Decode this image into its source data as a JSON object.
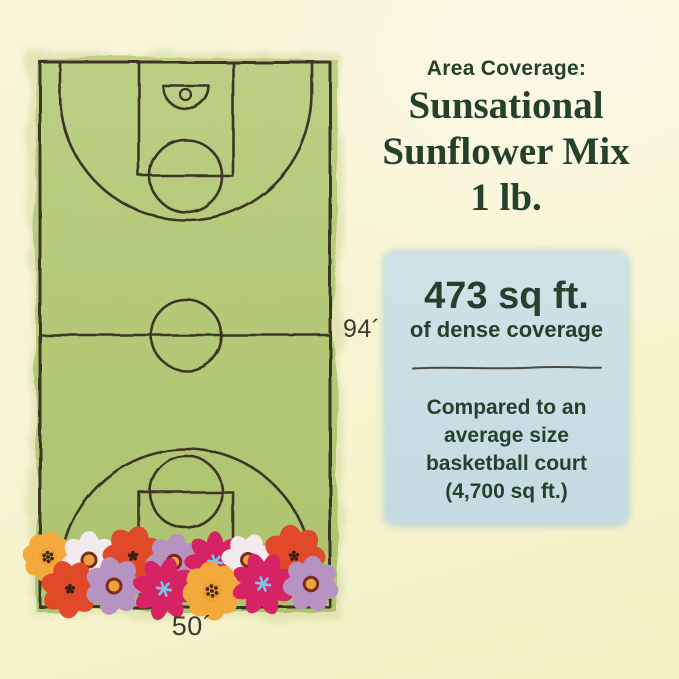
{
  "header": {
    "kicker": "Area Coverage:",
    "title_lines": [
      "Sunsational",
      "Sunflower Mix",
      "1 lb."
    ]
  },
  "stat_card": {
    "value": "473 sq ft.",
    "value_caption": "of dense coverage",
    "comparison_lines": [
      "Compared to an",
      "average size",
      "basketball court",
      "(4,700 sq ft.)"
    ]
  },
  "court": {
    "length_label": "94´",
    "width_label": "50´"
  },
  "colors": {
    "background": "#f7f4d1",
    "court_green": "#b5ca77",
    "line_ink": "#3e3426",
    "text_green": "#25402d",
    "card_blue": "#cadee4",
    "label_ink": "#3c3b30"
  },
  "illustration": {
    "flower_palette": {
      "marigold": {
        "petal": "#f4a93c",
        "center": "#f0a231",
        "dots": "#3a2a16"
      },
      "daisy": {
        "petal": "#f3eaee",
        "center": "#e8a23c",
        "ring": "#7c2d1d"
      },
      "poppy": {
        "petal": "#e04a28",
        "dots": "#2e1c12"
      },
      "cosmos_lavender": {
        "petal": "#b793c2",
        "center": "#eaa43c",
        "ring": "#7c2b20"
      },
      "cosmos_magenta": {
        "petal": "#d62364",
        "star": "#7cc4e7"
      }
    },
    "flowers": [
      {
        "x": 48,
        "y": 557,
        "r": 25,
        "type": "marigold",
        "rot": 10
      },
      {
        "x": 89,
        "y": 560,
        "r": 28,
        "type": "daisy",
        "rot": 0
      },
      {
        "x": 133,
        "y": 556,
        "r": 29,
        "type": "poppy",
        "rot": 15
      },
      {
        "x": 174,
        "y": 562,
        "r": 27,
        "type": "cosmos_lavender",
        "rot": 8
      },
      {
        "x": 215,
        "y": 562,
        "r": 28,
        "type": "cosmos_magenta",
        "rot": 0
      },
      {
        "x": 248,
        "y": 560,
        "r": 26,
        "type": "daisy",
        "rot": 20
      },
      {
        "x": 294,
        "y": 556,
        "r": 30,
        "type": "poppy",
        "rot": -10
      },
      {
        "x": 70,
        "y": 589,
        "r": 28,
        "type": "poppy",
        "rot": 30
      },
      {
        "x": 114,
        "y": 586,
        "r": 28,
        "type": "cosmos_lavender",
        "rot": -12
      },
      {
        "x": 164,
        "y": 589,
        "r": 29,
        "type": "cosmos_magenta",
        "rot": 14
      },
      {
        "x": 212,
        "y": 591,
        "r": 29,
        "type": "marigold",
        "rot": -6
      },
      {
        "x": 263,
        "y": 584,
        "r": 29,
        "type": "cosmos_magenta",
        "rot": -20
      },
      {
        "x": 311,
        "y": 584,
        "r": 27,
        "type": "cosmos_lavender",
        "rot": 5
      }
    ]
  }
}
